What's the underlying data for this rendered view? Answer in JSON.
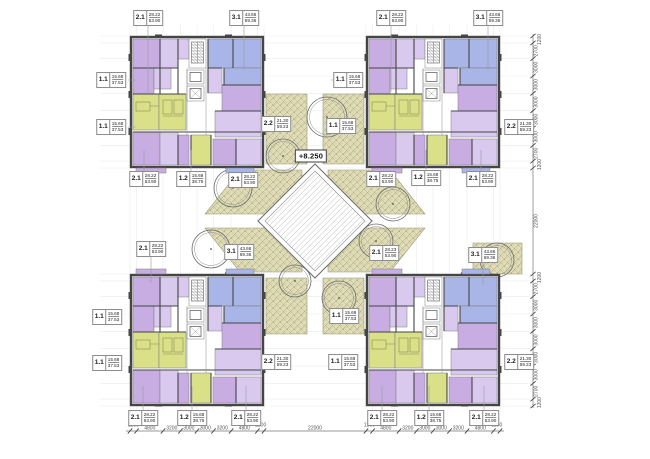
{
  "colors": {
    "wall": "#454545",
    "purple": "#c7ade2",
    "purple_light": "#d9c9ef",
    "blue": "#a9b4e7",
    "green": "#d9e088",
    "landscape": "#dfdcb6",
    "landscape_line": "#8f8d68",
    "dim_text": "#555555",
    "grid_line": "#ebebeb",
    "paper": "#ffffff"
  },
  "courtyard": {
    "elevation": "+8.250",
    "trees": [
      {
        "x": 283,
        "y": 156,
        "r": 17
      },
      {
        "x": 327,
        "y": 117,
        "r": 20
      },
      {
        "x": 233,
        "y": 188,
        "r": 19
      },
      {
        "x": 211,
        "y": 249,
        "r": 19
      },
      {
        "x": 295,
        "y": 281,
        "r": 16
      },
      {
        "x": 339,
        "y": 298,
        "r": 17
      },
      {
        "x": 393,
        "y": 204,
        "r": 17
      },
      {
        "x": 376,
        "y": 241,
        "r": 17
      },
      {
        "x": 497,
        "y": 260,
        "r": 17
      }
    ]
  },
  "apartment_labels": [
    {
      "type": "2.1",
      "area1": "28.22",
      "area2": "53.90",
      "x": 148,
      "y": 18
    },
    {
      "type": "3.1",
      "area1": "43.66",
      "area2": "69.36",
      "x": 244,
      "y": 18
    },
    {
      "type": "2.1",
      "area1": "28.22",
      "area2": "53.90",
      "x": 391,
      "y": 18
    },
    {
      "type": "3.1",
      "area1": "43.66",
      "area2": "69.36",
      "x": 488,
      "y": 18
    },
    {
      "type": "1.1",
      "area1": "15.68",
      "area2": "37.53",
      "x": 111,
      "y": 80
    },
    {
      "type": "1.1",
      "area1": "15.68",
      "area2": "37.53",
      "x": 111,
      "y": 127
    },
    {
      "type": "1.1",
      "area1": "15.68",
      "area2": "37.53",
      "x": 348,
      "y": 80
    },
    {
      "type": "2.2",
      "area1": "21.30",
      "area2": "59.23",
      "x": 519,
      "y": 127
    },
    {
      "type": "2.2",
      "area1": "21.30",
      "area2": "59.23",
      "x": 276,
      "y": 124
    },
    {
      "type": "1.1",
      "area1": "15.68",
      "area2": "37.53",
      "x": 341,
      "y": 126
    },
    {
      "type": "2.1",
      "area1": "28.22",
      "area2": "53.90",
      "x": 144,
      "y": 179
    },
    {
      "type": "1.2",
      "area1": "15.68",
      "area2": "38.75",
      "x": 191,
      "y": 179
    },
    {
      "type": "2.1",
      "area1": "28.22",
      "area2": "53.90",
      "x": 243,
      "y": 180
    },
    {
      "type": "2.1",
      "area1": "28.22",
      "area2": "53.90",
      "x": 381,
      "y": 179
    },
    {
      "type": "1.2",
      "area1": "15.68",
      "area2": "38.75",
      "x": 426,
      "y": 178
    },
    {
      "type": "2.1",
      "area1": "28.22",
      "area2": "53.90",
      "x": 481,
      "y": 179
    },
    {
      "type": "2.1",
      "area1": "28.22",
      "area2": "53.90",
      "x": 151,
      "y": 249
    },
    {
      "type": "3.1",
      "area1": "43.66",
      "area2": "69.36",
      "x": 239,
      "y": 252
    },
    {
      "type": "2.1",
      "area1": "28.23",
      "area2": "53.90",
      "x": 384,
      "y": 253
    },
    {
      "type": "3.1",
      "area1": "43.66",
      "area2": "69.36",
      "x": 483,
      "y": 255
    },
    {
      "type": "1.1",
      "area1": "15.68",
      "area2": "37.53",
      "x": 107,
      "y": 317
    },
    {
      "type": "1.1",
      "area1": "15.68",
      "area2": "37.53",
      "x": 107,
      "y": 363
    },
    {
      "type": "1.1",
      "area1": "15.68",
      "area2": "37.53",
      "x": 344,
      "y": 316
    },
    {
      "type": "2.2",
      "area1": "21.30",
      "area2": "59.23",
      "x": 276,
      "y": 362
    },
    {
      "type": "1.1",
      "area1": "15.68",
      "area2": "37.53",
      "x": 343,
      "y": 362
    },
    {
      "type": "2.2",
      "area1": "21.30",
      "area2": "59.23",
      "x": 519,
      "y": 362
    },
    {
      "type": "2.1",
      "area1": "28.22",
      "area2": "53.90",
      "x": 143,
      "y": 418
    },
    {
      "type": "1.2",
      "area1": "15.68",
      "area2": "38.75",
      "x": 192,
      "y": 418
    },
    {
      "type": "2.1",
      "area1": "28.22",
      "area2": "53.90",
      "x": 246,
      "y": 418
    },
    {
      "type": "2.1",
      "area1": "28.22",
      "area2": "53.90",
      "x": 382,
      "y": 418
    },
    {
      "type": "1.2",
      "area1": "15.68",
      "area2": "38.75",
      "x": 429,
      "y": 418
    },
    {
      "type": "2.1",
      "area1": "28.22",
      "area2": "53.90",
      "x": 484,
      "y": 418
    }
  ],
  "dimensions": {
    "bottom": {
      "ticks": [
        130,
        136.6,
        163,
        180.5,
        197,
        213.5,
        231.1,
        257.4,
        264,
        366,
        372.6,
        399,
        416.5,
        433,
        449.5,
        467.1,
        493.4,
        500
      ],
      "labels": [
        {
          "v": "1200",
          "x": 133.3
        },
        {
          "v": "4800",
          "x": 149.8
        },
        {
          "v": "3200",
          "x": 171.8
        },
        {
          "v": "3000",
          "x": 188.8
        },
        {
          "v": "3000",
          "x": 205.3
        },
        {
          "v": "3200",
          "x": 222.3
        },
        {
          "v": "4800",
          "x": 244.3
        },
        {
          "v": "1200",
          "x": 260.7
        },
        {
          "v": "22000",
          "x": 315
        },
        {
          "v": "1200",
          "x": 369.3
        },
        {
          "v": "4800",
          "x": 385.8
        },
        {
          "v": "3200",
          "x": 407.8
        },
        {
          "v": "3000",
          "x": 424.8
        },
        {
          "v": "3000",
          "x": 441.3
        },
        {
          "v": "3200",
          "x": 458.3
        },
        {
          "v": "4800",
          "x": 480.3
        },
        {
          "v": "1200",
          "x": 496.7
        }
      ]
    },
    "right": {
      "ticks": [
        36,
        42.9,
        58.6,
        76,
        93.3,
        110.7,
        128.1,
        145.4,
        161.1,
        168,
        274,
        280.9,
        296.6,
        314,
        331.3,
        348.7,
        366.1,
        383.4,
        399.1,
        406
      ],
      "labels": [
        {
          "v": "1200",
          "y": 39.5
        },
        {
          "v": "2700",
          "y": 50.8
        },
        {
          "v": "3000",
          "y": 67.3
        },
        {
          "v": "3000",
          "y": 84.7
        },
        {
          "v": "3000",
          "y": 102
        },
        {
          "v": "3000",
          "y": 119.4
        },
        {
          "v": "3000",
          "y": 136.8
        },
        {
          "v": "2700",
          "y": 153.3
        },
        {
          "v": "1200",
          "y": 164.6
        },
        {
          "v": "22000",
          "y": 221
        },
        {
          "v": "1200",
          "y": 277.5
        },
        {
          "v": "2700",
          "y": 288.8
        },
        {
          "v": "3000",
          "y": 305.3
        },
        {
          "v": "3000",
          "y": 322.7
        },
        {
          "v": "3000",
          "y": 340
        },
        {
          "v": "3000",
          "y": 357.4
        },
        {
          "v": "3000",
          "y": 374.8
        },
        {
          "v": "2700",
          "y": 391.3
        },
        {
          "v": "1200",
          "y": 402.6
        }
      ]
    }
  }
}
